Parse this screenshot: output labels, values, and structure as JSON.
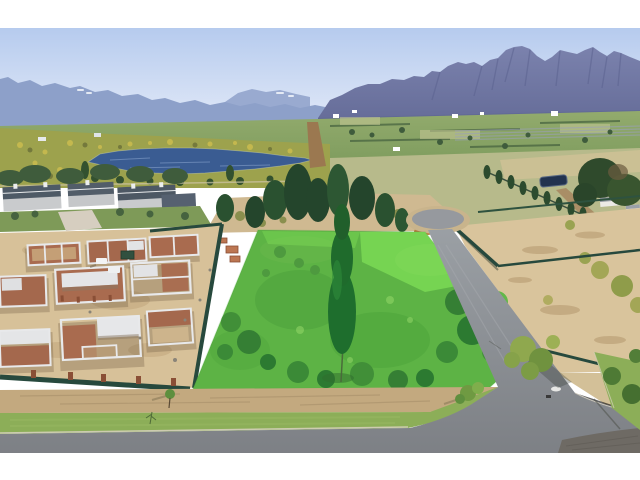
{
  "image": {
    "description": "Aerial drone photograph of a winelands residential estate: a vacant stand highlighted bright green beside houses under construction, with a dam, fynbos, farmland and a rocky mountain range behind",
    "format": "letterboxed-photo-3x2",
    "letterbox_color": "#ffffff"
  },
  "palette": {
    "sky_top": "#b6cbee",
    "sky_horizon": "#e3eaf8",
    "mountains_far": "#8da0c9",
    "mountains_far_back": "#99aad0",
    "mountains_near_top": "#7b82ad",
    "mountains_near_base": "#666d99",
    "snow_patch": "#eef2f8",
    "valley_green": "#7e9c5e",
    "valley_trees": "#41603d",
    "fynbos_olive": "#9da24d",
    "fynbos_yellow": "#c9bb4f",
    "lake_water": "#3a5c92",
    "pine_tree": "#24452c",
    "house_roof": "#4e5a66",
    "house_wall": "#c9cbcd",
    "sand": "#d7c199",
    "brick": "#a96b4f",
    "concrete": "#e8e9eb",
    "fence_green": "#27493d",
    "plot_highlight": "#3ecc3a",
    "plot_highlight_bright": "#8aef5c",
    "plot_tree": "#1e6e2d",
    "road_asphalt": "#8b8e93",
    "road_paver": "#6e6a64",
    "road_marking": "#f2f2ee",
    "grass_verge": "#8cae58",
    "dirt_strip": "#c3a97f",
    "curb": "#d9d2c0"
  },
  "scene": {
    "regions": [
      "sky",
      "distant-mountains",
      "rocky-mountain-range",
      "valley-farmland",
      "fynbos-shrubland",
      "dam-lake",
      "farm-buildings",
      "estate-houses",
      "construction-site",
      "construction-fence",
      "highlighted-vacant-plot",
      "central-conifer-tree",
      "cul-de-sac",
      "estate-access-road",
      "boundary-road",
      "grass-verge",
      "vacant-neighbour-plots"
    ]
  }
}
